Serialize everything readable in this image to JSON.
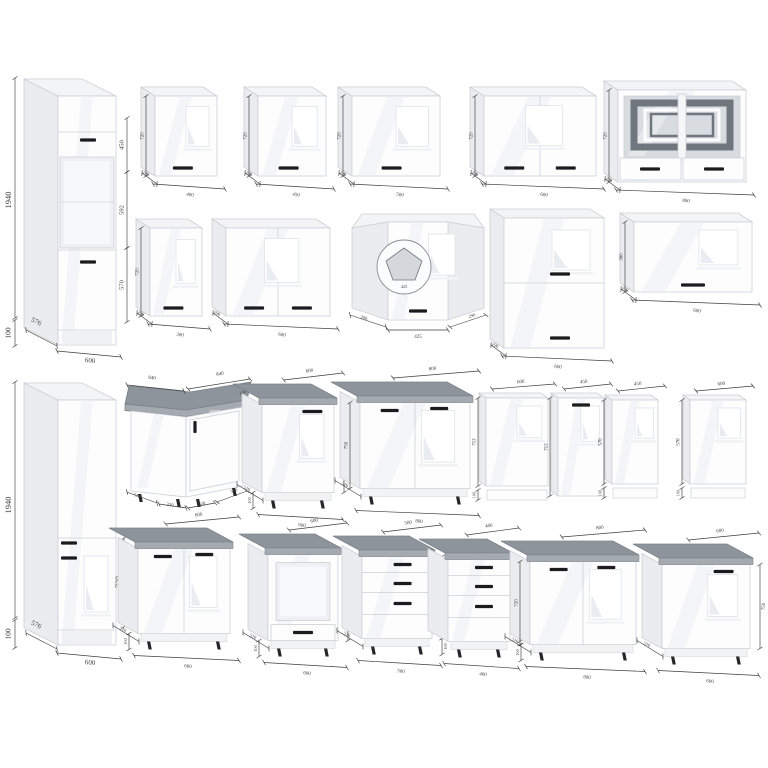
{
  "canvas": {
    "w": 768,
    "h": 768,
    "bg": "#ffffff"
  },
  "palette": {
    "front": "#fdfdfe",
    "edge": "#cbd0d5",
    "side": "#eaecef",
    "top": "#f3f4f6",
    "gloss": "#e9edf1",
    "handle": "#1c1c1f",
    "ctTop": "#8e949b",
    "ctBand": "#a5aab1",
    "ctEdge": "#7c828a",
    "dim": "#3e3e40",
    "glassBg": "#d8dce0",
    "glassBand": "#70767e",
    "winEdge": "#e2e6ea",
    "leg": "#26262a"
  },
  "cabinets": [
    {
      "name": "tall-cabinet-oven-600",
      "type": "tallOven",
      "x": 58,
      "y": 96,
      "w": 58,
      "h": 249,
      "dx": 34,
      "dy": 17,
      "handles": [
        [
          88,
          140,
          16
        ],
        [
          88,
          262,
          16
        ]
      ],
      "dims": [
        {
          "label": "1940",
          "fs": 8.5,
          "rot": -90,
          "x": 9,
          "y": 200,
          "line": [
            15,
            78,
            15,
            318
          ]
        },
        {
          "label": "100",
          "fs": 7.5,
          "rot": -90,
          "x": 9,
          "y": 333,
          "line": [
            15,
            320,
            15,
            346
          ]
        },
        {
          "label": "576",
          "fs": 7,
          "rot": 26,
          "x": 36,
          "y": 322,
          "line": [
            26,
            330,
            57,
            346
          ]
        },
        {
          "label": "600",
          "fs": 7,
          "rot": 7,
          "x": 90,
          "y": 361,
          "line": [
            57,
            351,
            121,
            357
          ]
        },
        {
          "label": "450",
          "fs": 6.5,
          "rot": -90,
          "x": 122,
          "y": 145,
          "line": [
            127,
            118,
            127,
            172
          ]
        },
        {
          "label": "592",
          "fs": 6.5,
          "rot": -90,
          "x": 122,
          "y": 210,
          "line": [
            127,
            172,
            127,
            248
          ]
        },
        {
          "label": "570",
          "fs": 6.5,
          "rot": -90,
          "x": 122,
          "y": 285,
          "line": [
            127,
            248,
            127,
            322
          ]
        }
      ]
    },
    {
      "name": "wall-cabinet-400",
      "type": "wall",
      "x": 155,
      "y": 96,
      "w": 62,
      "h": 80,
      "dx": 14,
      "dy": 9,
      "doors": 1,
      "labels": {
        "bottom": "400",
        "left": "720",
        "depth": "296"
      }
    },
    {
      "name": "wall-cabinet-450",
      "type": "wall",
      "x": 258,
      "y": 96,
      "w": 68,
      "h": 80,
      "dx": 14,
      "dy": 9,
      "doors": 1,
      "labels": {
        "bottom": "450",
        "left": "720",
        "depth": "296"
      }
    },
    {
      "name": "wall-cabinet-500",
      "type": "wall",
      "x": 352,
      "y": 96,
      "w": 88,
      "h": 80,
      "dx": 14,
      "dy": 9,
      "doors": 1,
      "labels": {
        "bottom": "500",
        "left": "720",
        "depth": "296"
      }
    },
    {
      "name": "wall-cabinet-600-double",
      "type": "wall",
      "x": 484,
      "y": 96,
      "w": 112,
      "h": 80,
      "dx": 14,
      "dy": 9,
      "doors": 2,
      "labels": {
        "bottom": "600",
        "left": "720",
        "depth": "296"
      }
    },
    {
      "name": "wall-cabinet-800-glass",
      "type": "wallGlass",
      "x": 618,
      "y": 90,
      "w": 128,
      "h": 92,
      "dx": 14,
      "dy": 9,
      "labels": {
        "bottom": "800",
        "left": "720",
        "depth": "296"
      }
    },
    {
      "name": "wall-cabinet-300",
      "type": "wall",
      "x": 150,
      "y": 228,
      "w": 52,
      "h": 88,
      "dx": 14,
      "dy": 9,
      "doors": 1,
      "labels": {
        "bottom": "300",
        "left": "720",
        "depth": "296"
      }
    },
    {
      "name": "wall-cabinet-600-double-2",
      "type": "wall",
      "x": 226,
      "y": 228,
      "w": 104,
      "h": 88,
      "dx": 14,
      "dy": 9,
      "doors": 2,
      "labels": {
        "bottom": "600",
        "depth": "296"
      }
    },
    {
      "name": "wall-cabinet-corner-425",
      "type": "wallCorner",
      "x": 352,
      "y": 222,
      "w": 132,
      "h": 98,
      "dx": 14,
      "dy": 9,
      "inset": {
        "cx": 404,
        "cy": 267,
        "r": 27,
        "label": "425"
      },
      "dims": [
        {
          "label": "296",
          "x": 364,
          "y": 318,
          "rot": 17,
          "fs": 4.5,
          "line": [
            350,
            315,
            386,
            327
          ]
        },
        {
          "label": "425",
          "x": 418,
          "y": 337,
          "rot": 0,
          "fs": 5,
          "line": [
            388,
            330,
            448,
            330
          ]
        },
        {
          "label": "296",
          "x": 472,
          "y": 316,
          "rot": -17,
          "fs": 4.5,
          "line": [
            450,
            327,
            486,
            315
          ]
        },
        {
          "label": "720",
          "x": 496,
          "y": 271,
          "rot": -90,
          "fs": 5,
          "line": [
            492,
            222,
            492,
            320
          ]
        }
      ]
    },
    {
      "name": "wall-cabinet-600-stacked",
      "type": "wallStacked",
      "x": 504,
      "y": 218,
      "w": 100,
      "h": 130,
      "dx": 14,
      "dy": 9,
      "labels": {
        "bottom": "600",
        "depth": "296"
      }
    },
    {
      "name": "wall-cabinet-600-horizontal",
      "type": "wall",
      "x": 634,
      "y": 222,
      "w": 118,
      "h": 70,
      "dx": 14,
      "dy": 9,
      "doors": 1,
      "horizontal": true,
      "labels": {
        "bottom": "600",
        "left": "360",
        "depth": "296"
      }
    },
    {
      "name": "tall-cabinet-pantry-600",
      "type": "tallPantry",
      "x": 58,
      "y": 400,
      "w": 58,
      "h": 245,
      "dx": 34,
      "dy": 17,
      "handles": [
        [
          69,
          543,
          16
        ],
        [
          69,
          558,
          16
        ]
      ],
      "dims": [
        {
          "label": "1940",
          "fs": 8.5,
          "rot": -90,
          "x": 9,
          "y": 505,
          "line": [
            15,
            382,
            15,
            618
          ]
        },
        {
          "label": "100",
          "fs": 7.5,
          "rot": -90,
          "x": 9,
          "y": 634,
          "line": [
            15,
            620,
            15,
            648
          ]
        },
        {
          "label": "576",
          "fs": 7,
          "rot": 26,
          "x": 36,
          "y": 625,
          "line": [
            26,
            633,
            57,
            649
          ]
        },
        {
          "label": "600",
          "fs": 7,
          "rot": 7,
          "x": 90,
          "y": 663,
          "line": [
            57,
            653,
            121,
            659
          ]
        },
        {
          "label": "720",
          "fs": 8,
          "rot": -90,
          "x": 119,
          "y": 582,
          "line": [
            124,
            538,
            124,
            627
          ]
        }
      ]
    },
    {
      "name": "base-cabinet-corner-840",
      "type": "baseCorner",
      "x": 125,
      "dims": [
        {
          "label": "840",
          "x": 152,
          "y": 378,
          "rot": 6,
          "fs": 5,
          "line": [
            127,
            385,
            184,
            391
          ]
        },
        {
          "label": "840",
          "x": 220,
          "y": 374,
          "rot": -9,
          "fs": 5,
          "line": [
            188,
            389,
            250,
            379
          ]
        },
        {
          "label": "600",
          "x": 243,
          "y": 393,
          "rot": -27,
          "fs": 4.4
        },
        {
          "label": "516",
          "x": 137,
          "y": 496,
          "rot": 22,
          "fs": 4.6,
          "line": [
            127,
            492,
            157,
            503
          ]
        },
        {
          "label": "320",
          "x": 170,
          "y": 505,
          "rot": 9,
          "fs": 4.6,
          "line": [
            159,
            504,
            186,
            508
          ]
        },
        {
          "label": "320",
          "x": 202,
          "y": 504,
          "rot": -9,
          "fs": 4.6,
          "line": [
            188,
            508,
            215,
            503
          ]
        },
        {
          "label": "516",
          "x": 234,
          "y": 491,
          "rot": -22,
          "fs": 4.6,
          "line": [
            217,
            502,
            247,
            491
          ]
        }
      ]
    },
    {
      "name": "base-cabinet-600",
      "type": "base",
      "x": 262,
      "yT": 398,
      "w": 72,
      "bodyH": 88,
      "dx": 26,
      "dy": 14,
      "doors": 1,
      "labels": {
        "top": "600",
        "right": "750",
        "depth": "516",
        "bottom": "600",
        "left100": "100"
      }
    },
    {
      "name": "base-cabinet-800-double",
      "type": "base",
      "x": 360,
      "yT": 396,
      "w": 110,
      "bodyH": 86,
      "dx": 26,
      "dy": 14,
      "doors": 2,
      "labels": {
        "top": "800",
        "left": "750",
        "depth": "516",
        "bottom": "800"
      }
    },
    {
      "name": "front-panel-600",
      "type": "panel",
      "x": 486,
      "y": 398,
      "w": 62,
      "h": 88,
      "dx": 7,
      "dy": 5,
      "strip": true,
      "labels": {
        "top": "600",
        "left": "713",
        "left100": "100"
      }
    },
    {
      "name": "front-panel-450-handle",
      "type": "panel",
      "x": 558,
      "y": 398,
      "w": 46,
      "h": 98,
      "dx": 7,
      "dy": 5,
      "handle": true,
      "labels": {
        "top": "450",
        "left": "713"
      }
    },
    {
      "name": "front-panel-450",
      "type": "panel",
      "x": 612,
      "y": 400,
      "w": 46,
      "h": 84,
      "dx": 7,
      "dy": 5,
      "strip": true,
      "labels": {
        "top": "450",
        "left": "570",
        "left100": "100"
      }
    },
    {
      "name": "front-panel-600-2",
      "type": "panel",
      "x": 690,
      "y": 400,
      "w": 56,
      "h": 84,
      "dx": 7,
      "dy": 5,
      "strip": true,
      "labels": {
        "top": "600",
        "left": "570",
        "left100": "100"
      }
    },
    {
      "name": "base-cabinet-600-double",
      "type": "base",
      "x": 138,
      "yT": 542,
      "w": 92,
      "bodyH": 85,
      "dx": 26,
      "dy": 14,
      "doors": 2,
      "labels": {
        "top": "600",
        "depth": "516",
        "bottom": "600",
        "left100": "100"
      }
    },
    {
      "name": "base-cabinet-oven-600",
      "type": "baseOven",
      "x": 268,
      "yT": 548,
      "w": 70,
      "bodyH": 86,
      "dx": 26,
      "dy": 14,
      "labels": {
        "top": "600",
        "right": "750",
        "depth": "516",
        "bottom": "600",
        "left100": "100"
      }
    },
    {
      "name": "base-cabinet-drawers-500",
      "type": "baseDrawers",
      "x": 362,
      "yT": 550,
      "w": 70,
      "bodyH": 82,
      "dx": 26,
      "dy": 14,
      "labels": {
        "top": "500",
        "right": "750",
        "right100": "100",
        "depth": "516",
        "bottom": "500"
      }
    },
    {
      "name": "base-cabinet-drawers-400",
      "type": "baseDrawers",
      "x": 448,
      "yT": 553,
      "w": 62,
      "bodyH": 82,
      "dx": 26,
      "dy": 14,
      "labels": {
        "top": "400",
        "right": "720",
        "bottom": "400"
      }
    },
    {
      "name": "base-cabinet-800-double-2",
      "type": "base",
      "x": 530,
      "yT": 555,
      "w": 106,
      "bodyH": 83,
      "dx": 26,
      "dy": 14,
      "doors": 2,
      "labels": {
        "top": "800",
        "left": "720",
        "left100": "100",
        "depth": "516",
        "bottom": "800"
      }
    },
    {
      "name": "base-cabinet-600-single",
      "type": "base",
      "x": 662,
      "yT": 558,
      "w": 88,
      "bodyH": 84,
      "dx": 26,
      "dy": 14,
      "doors": 1,
      "labels": {
        "top": "600",
        "right": "750",
        "depth": "516",
        "bottom": "600"
      }
    }
  ]
}
